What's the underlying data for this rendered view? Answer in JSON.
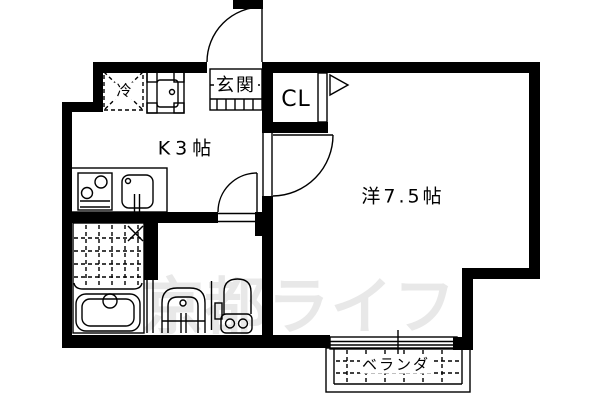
{
  "floor_plan": {
    "type": "japanese-apartment-floor-plan",
    "rooms": {
      "kitchen": {
        "label": "K3帖"
      },
      "western_room": {
        "label": "洋7.5帖"
      },
      "closet": {
        "label": "CL"
      },
      "entrance": {
        "label": "玄関"
      },
      "veranda": {
        "label": "ベランダ"
      },
      "refrigerator": {
        "label": "冷"
      }
    },
    "fixtures": [
      "entrance-door",
      "room-door",
      "washroom-door",
      "closet-folding-door",
      "refrigerator-space",
      "washing-machine",
      "stove-2-burner",
      "kitchen-sink",
      "shower-room-grid",
      "bathtub",
      "washbasin",
      "toilet",
      "sliding-window",
      "veranda-deck"
    ],
    "watermark": {
      "text": "京都ライフ",
      "color": "#e8e8e8"
    },
    "colors": {
      "wall": "#000000",
      "background": "#ffffff",
      "line": "#000000"
    }
  }
}
